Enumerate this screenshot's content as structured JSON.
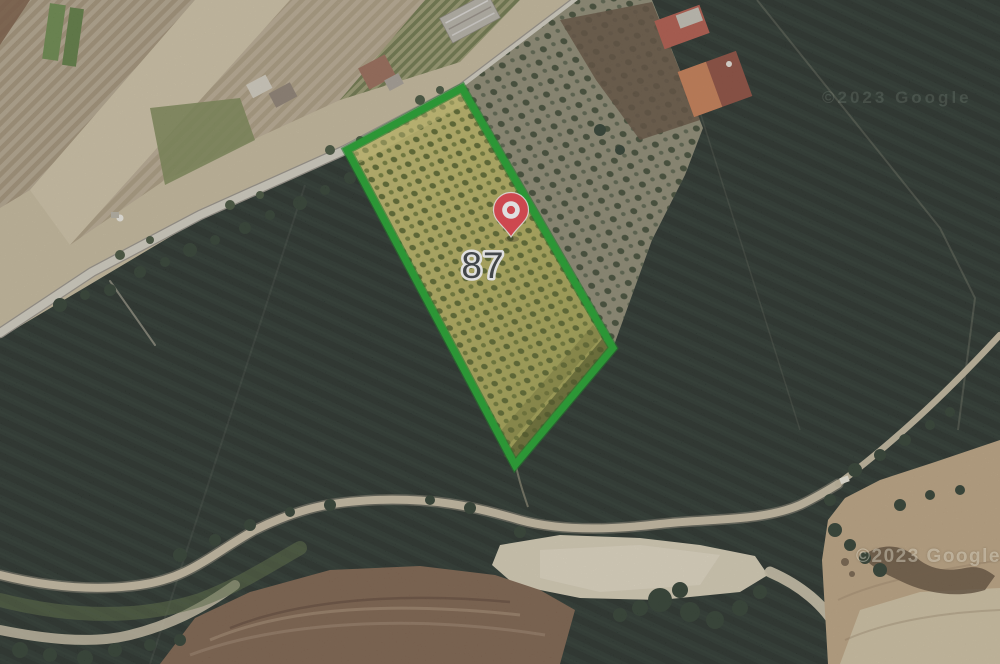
{
  "map": {
    "parcel": {
      "number": "87",
      "outline_color": "#1FA32B",
      "fill_color": "#B4AE5A",
      "points": "462,88 613,348 515,465 347,150"
    },
    "marker": {
      "pin_color": "#E8414A",
      "pin_transform": "translate(511,237)",
      "label_color": "#3A3F42",
      "label_halo": "#FFFFFF"
    },
    "watermarks": [
      {
        "text": "©2023 Google"
      },
      {
        "text": "©2023 Google"
      }
    ]
  }
}
